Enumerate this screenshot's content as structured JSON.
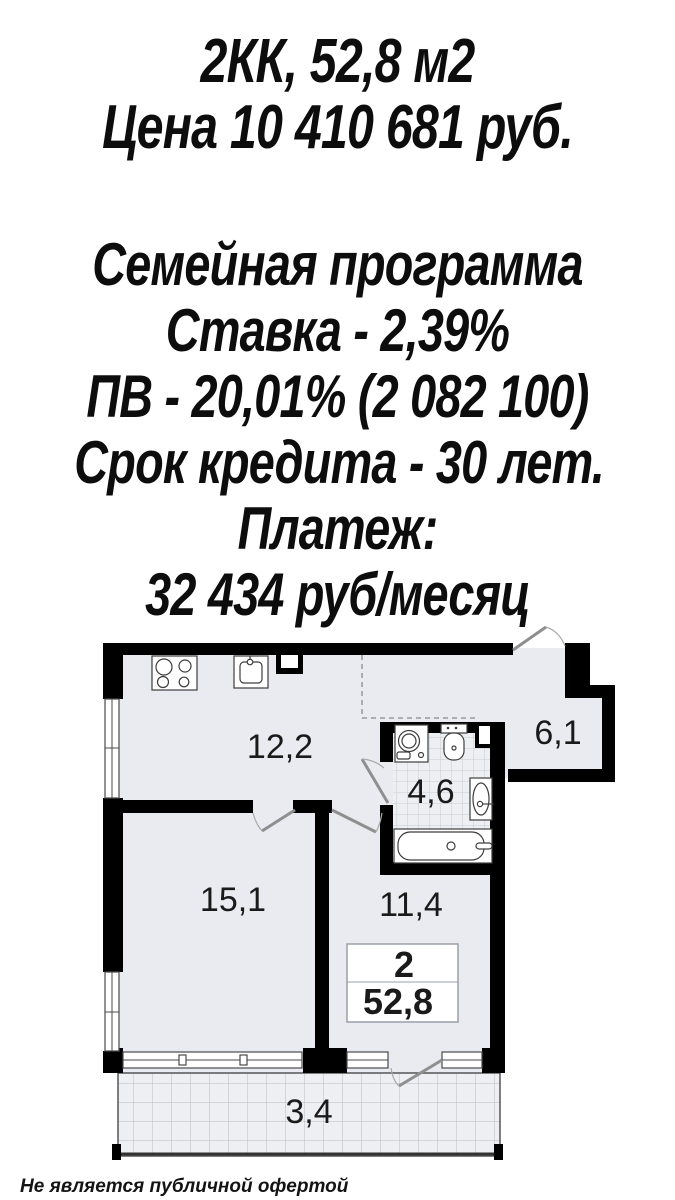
{
  "header": {
    "line1": "2КК, 52,8 м2",
    "line2": "Цена 10 410 681 руб."
  },
  "offer": {
    "lines": [
      "Семейная программа",
      "Ставка - 2,39%",
      "ПВ - 20,01% (2 082 100)",
      "Срок кредита - 30 лет.",
      "Платеж:",
      "32 434 руб/месяц"
    ]
  },
  "floorplan": {
    "rooms": {
      "kitchen_living": "12,2",
      "hall": "6,1",
      "bathroom": "4,6",
      "living": "15,1",
      "bedroom": "11,4",
      "balcony": "3,4"
    },
    "info_box": {
      "rooms_count": "2",
      "total_area": "52,8"
    }
  },
  "footer": {
    "disclaimer": "Не является публичной офертой"
  },
  "colors": {
    "wall": "#000000",
    "room_fill": "#e9ebf0",
    "tile_fill": "#edeff3",
    "text": "#111111"
  }
}
